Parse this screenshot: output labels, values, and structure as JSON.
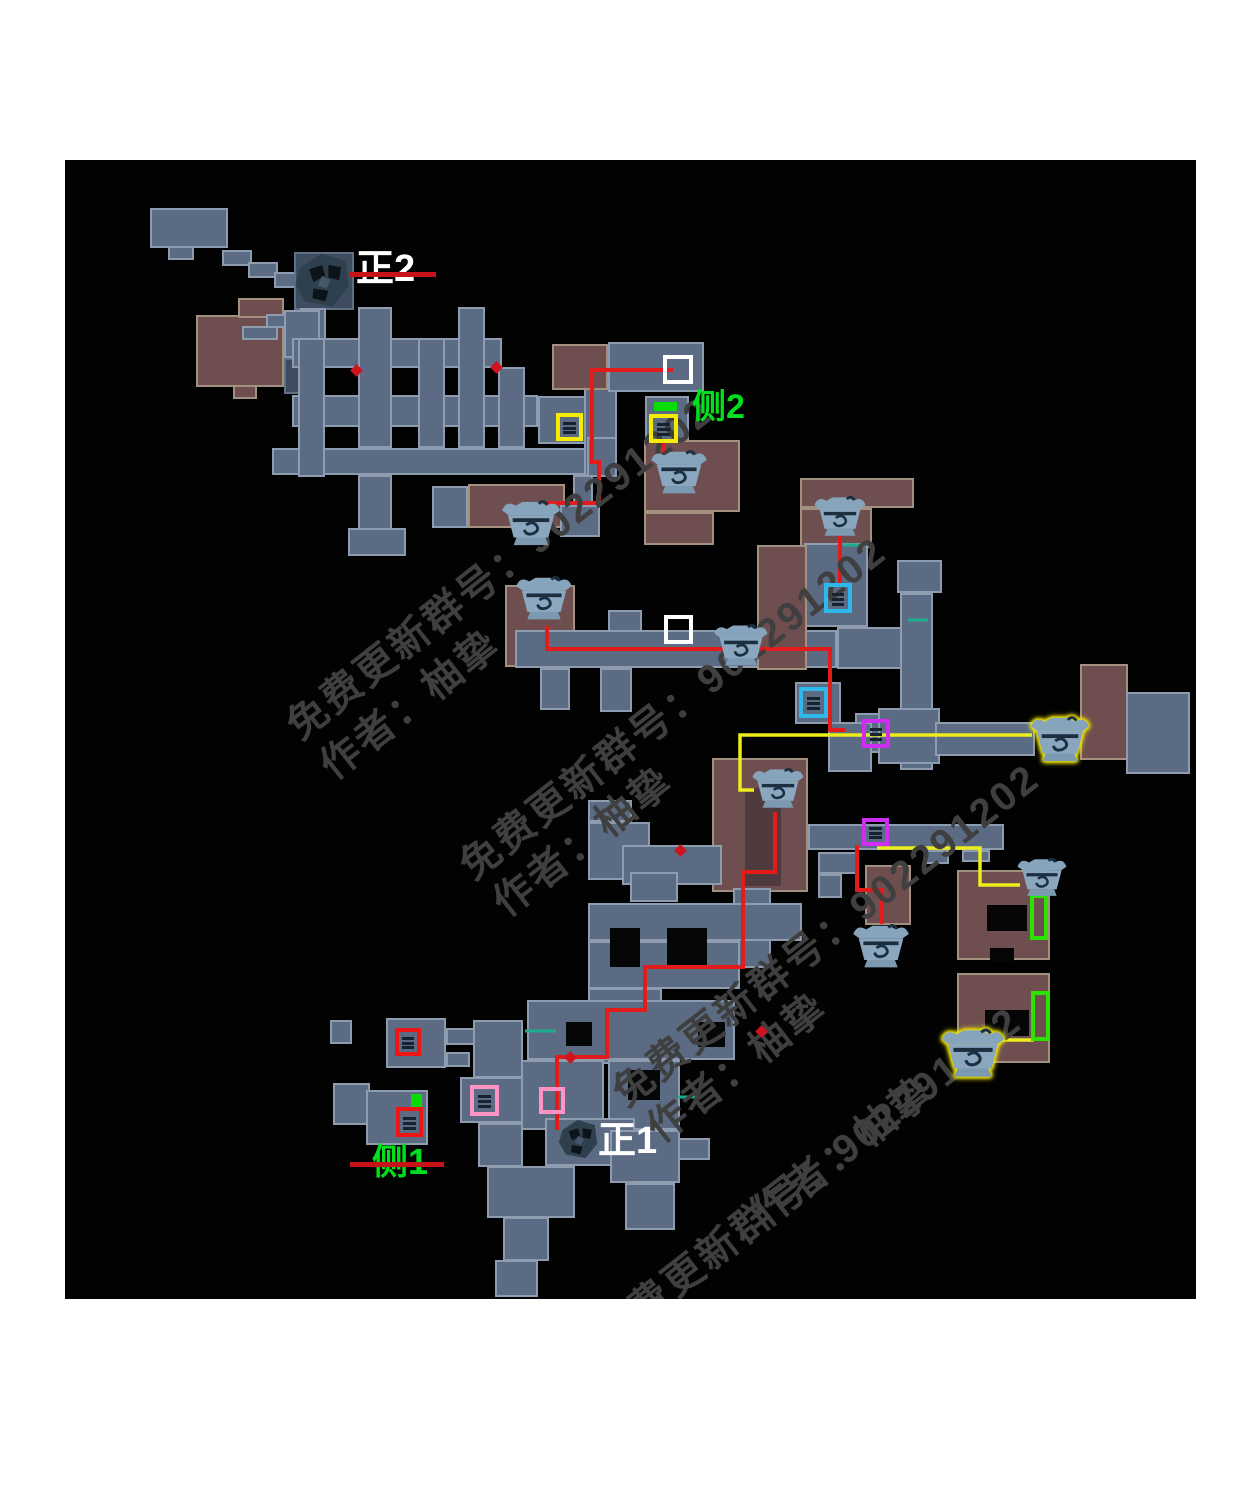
{
  "map": {
    "area": {
      "x": 65,
      "y": 160,
      "w": 1131,
      "h": 1139
    },
    "colors": {
      "background": "#020202",
      "page": "#ffffff",
      "room_gray": "#5b6b83",
      "room_maroon": "#6f4e50",
      "red_path": "#e31b1b",
      "yellow_path": "#eded1a",
      "teal_tick": "#1fae8d",
      "watermark": "#3f3f3f",
      "label_green": "#00e01e",
      "label_white": "#ffffff"
    },
    "rooms": [
      [
        196,
        315,
        88,
        72,
        "m"
      ],
      [
        238,
        298,
        46,
        20,
        "m"
      ],
      [
        233,
        385,
        24,
        14,
        "m"
      ],
      [
        150,
        208,
        78,
        40,
        "g"
      ],
      [
        168,
        246,
        26,
        14,
        "g"
      ],
      [
        222,
        250,
        30,
        16,
        "g"
      ],
      [
        248,
        262,
        30,
        16,
        "g"
      ],
      [
        274,
        272,
        30,
        16,
        "g"
      ],
      [
        294,
        252,
        60,
        58,
        "gd"
      ],
      [
        300,
        308,
        26,
        32,
        "g"
      ],
      [
        266,
        314,
        36,
        14,
        "g"
      ],
      [
        242,
        326,
        36,
        14,
        "g"
      ],
      [
        284,
        310,
        36,
        48,
        "g"
      ],
      [
        284,
        358,
        36,
        36,
        "gd"
      ],
      [
        292,
        338,
        210,
        30,
        "g"
      ],
      [
        292,
        395,
        246,
        32,
        "g"
      ],
      [
        538,
        396,
        54,
        48,
        "g"
      ],
      [
        272,
        448,
        320,
        27,
        "g"
      ],
      [
        298,
        338,
        27,
        139,
        "g"
      ],
      [
        358,
        307,
        34,
        141,
        "g"
      ],
      [
        358,
        475,
        34,
        55,
        "g"
      ],
      [
        348,
        528,
        58,
        28,
        "g"
      ],
      [
        418,
        338,
        27,
        110,
        "g"
      ],
      [
        458,
        307,
        27,
        141,
        "g"
      ],
      [
        498,
        367,
        27,
        81,
        "g"
      ],
      [
        584,
        362,
        33,
        114,
        "g"
      ],
      [
        587,
        437,
        30,
        40,
        "g"
      ],
      [
        573,
        475,
        20,
        30,
        "g"
      ],
      [
        432,
        486,
        36,
        42,
        "g"
      ],
      [
        468,
        484,
        97,
        44,
        "m"
      ],
      [
        560,
        505,
        40,
        32,
        "g"
      ],
      [
        552,
        344,
        56,
        46,
        "m"
      ],
      [
        608,
        342,
        96,
        50,
        "g"
      ],
      [
        645,
        396,
        44,
        50,
        "g"
      ],
      [
        644,
        440,
        96,
        72,
        "m"
      ],
      [
        644,
        512,
        70,
        33,
        "m"
      ],
      [
        800,
        478,
        114,
        30,
        "m"
      ],
      [
        800,
        508,
        72,
        40,
        "m"
      ],
      [
        804,
        543,
        64,
        84,
        "g"
      ],
      [
        505,
        585,
        70,
        82,
        "m"
      ],
      [
        515,
        630,
        322,
        38,
        "g"
      ],
      [
        540,
        668,
        30,
        42,
        "g"
      ],
      [
        600,
        668,
        32,
        44,
        "g"
      ],
      [
        608,
        610,
        34,
        22,
        "g"
      ],
      [
        757,
        545,
        50,
        125,
        "m"
      ],
      [
        837,
        627,
        68,
        42,
        "g"
      ],
      [
        897,
        560,
        45,
        33,
        "g"
      ],
      [
        900,
        593,
        33,
        177,
        "g"
      ],
      [
        795,
        682,
        46,
        42,
        "g"
      ],
      [
        855,
        713,
        46,
        40,
        "g"
      ],
      [
        828,
        722,
        44,
        50,
        "g"
      ],
      [
        878,
        708,
        62,
        56,
        "g"
      ],
      [
        935,
        722,
        100,
        34,
        "g"
      ],
      [
        1080,
        664,
        48,
        96,
        "m"
      ],
      [
        1126,
        692,
        64,
        82,
        "g"
      ],
      [
        808,
        824,
        196,
        26,
        "g"
      ],
      [
        925,
        850,
        24,
        14,
        "g"
      ],
      [
        962,
        850,
        28,
        12,
        "g"
      ],
      [
        818,
        852,
        40,
        22,
        "g"
      ],
      [
        818,
        874,
        24,
        24,
        "g"
      ],
      [
        865,
        865,
        46,
        60,
        "m"
      ],
      [
        957,
        870,
        93,
        90,
        "m"
      ],
      [
        957,
        973,
        93,
        90,
        "m"
      ],
      [
        712,
        758,
        96,
        134,
        "m"
      ],
      [
        745,
        788,
        36,
        98,
        "md"
      ],
      [
        588,
        800,
        44,
        22,
        "g"
      ],
      [
        588,
        822,
        62,
        58,
        "g"
      ],
      [
        622,
        845,
        100,
        40,
        "g"
      ],
      [
        630,
        872,
        48,
        30,
        "g"
      ],
      [
        733,
        888,
        38,
        80,
        "g"
      ],
      [
        588,
        903,
        214,
        38,
        "g"
      ],
      [
        588,
        941,
        152,
        48,
        "g"
      ],
      [
        588,
        988,
        74,
        28,
        "g"
      ],
      [
        600,
        1014,
        62,
        50,
        "g"
      ],
      [
        527,
        1000,
        208,
        60,
        "g"
      ],
      [
        520,
        1060,
        84,
        70,
        "g"
      ],
      [
        608,
        1060,
        72,
        70,
        "g"
      ],
      [
        545,
        1118,
        90,
        48,
        "g"
      ],
      [
        487,
        1166,
        88,
        52,
        "g"
      ],
      [
        503,
        1217,
        46,
        44,
        "g"
      ],
      [
        495,
        1260,
        43,
        37,
        "g"
      ],
      [
        610,
        1130,
        70,
        53,
        "g"
      ],
      [
        625,
        1183,
        50,
        47,
        "g"
      ],
      [
        678,
        1138,
        32,
        22,
        "g"
      ],
      [
        386,
        1018,
        60,
        50,
        "g"
      ],
      [
        446,
        1028,
        32,
        17,
        "g"
      ],
      [
        446,
        1052,
        24,
        15,
        "g"
      ],
      [
        330,
        1020,
        22,
        24,
        "g"
      ],
      [
        333,
        1083,
        37,
        42,
        "g"
      ],
      [
        366,
        1090,
        62,
        55,
        "g"
      ],
      [
        473,
        1020,
        50,
        58,
        "g"
      ],
      [
        460,
        1077,
        63,
        46,
        "g"
      ],
      [
        478,
        1123,
        45,
        44,
        "g"
      ]
    ],
    "holes": [
      [
        566,
        1022,
        26,
        24
      ],
      [
        698,
        1022,
        27,
        25
      ],
      [
        628,
        1070,
        32,
        30
      ],
      [
        610,
        928,
        30,
        39
      ],
      [
        667,
        928,
        40,
        39
      ],
      [
        987,
        905,
        40,
        26
      ],
      [
        990,
        948,
        24,
        14
      ],
      [
        985,
        1010,
        44,
        26
      ]
    ],
    "paths": [
      {
        "c": "red",
        "pts": [
          [
            673,
            370
          ],
          [
            592,
            370
          ],
          [
            592,
            462
          ],
          [
            599,
            462
          ],
          [
            599,
            503
          ],
          [
            548,
            503
          ],
          [
            548,
            512
          ]
        ]
      },
      {
        "c": "red",
        "pts": [
          [
            664,
            441
          ],
          [
            664,
            458
          ]
        ]
      },
      {
        "c": "red",
        "pts": [
          [
            840,
            535
          ],
          [
            840,
            586
          ]
        ]
      },
      {
        "c": "red",
        "pts": [
          [
            547,
            626
          ],
          [
            547,
            649
          ],
          [
            830,
            649
          ],
          [
            830,
            730
          ],
          [
            845,
            730
          ]
        ]
      },
      {
        "c": "red",
        "pts": [
          [
            857,
            845
          ],
          [
            857,
            890
          ],
          [
            882,
            890
          ],
          [
            882,
            924
          ]
        ]
      },
      {
        "c": "red",
        "pts": [
          [
            775,
            812
          ],
          [
            775,
            872
          ],
          [
            743,
            872
          ],
          [
            743,
            967
          ],
          [
            645,
            967
          ],
          [
            645,
            1010
          ],
          [
            607,
            1010
          ],
          [
            607,
            1057
          ],
          [
            557,
            1057
          ],
          [
            557,
            1130
          ]
        ]
      },
      {
        "c": "yellow",
        "pts": [
          [
            754,
            790
          ],
          [
            740,
            790
          ],
          [
            740,
            735
          ],
          [
            1032,
            735
          ]
        ]
      },
      {
        "c": "yellow",
        "pts": [
          [
            877,
            848
          ],
          [
            980,
            848
          ],
          [
            980,
            885
          ],
          [
            1020,
            885
          ]
        ]
      },
      {
        "c": "yellow",
        "pts": [
          [
            1002,
            1040
          ],
          [
            1034,
            1040
          ]
        ]
      }
    ],
    "markers": [
      [
        663,
        355,
        30,
        29,
        "#ffffff",
        false
      ],
      [
        664,
        615,
        29,
        29,
        "#ffffff",
        false
      ],
      [
        556,
        413,
        27,
        28,
        "#f6ec00",
        true
      ],
      [
        649,
        414,
        29,
        29,
        "#f6ec00",
        true
      ],
      [
        824,
        583,
        28,
        30,
        "#2fb9ea",
        true
      ],
      [
        799,
        687,
        29,
        31,
        "#2fb9ea",
        true
      ],
      [
        862,
        719,
        28,
        29,
        "#cf2df2",
        true
      ],
      [
        862,
        818,
        27,
        28,
        "#cf2df2",
        true
      ],
      [
        470,
        1085,
        29,
        31,
        "#ff93c4",
        true
      ],
      [
        539,
        1087,
        26,
        27,
        "#ff93c4",
        false
      ],
      [
        395,
        1028,
        26,
        28,
        "#ee1515",
        true
      ],
      [
        396,
        1107,
        27,
        30,
        "#ee1515",
        true
      ],
      [
        1030,
        894,
        18,
        46,
        "#2ce300",
        false
      ],
      [
        1031,
        991,
        19,
        50,
        "#2ce300",
        false
      ]
    ],
    "platforms": [
      [
        654,
        402,
        23,
        9
      ],
      [
        411,
        1094,
        11,
        17
      ]
    ],
    "chests": [
      [
        500,
        498,
        62,
        52,
        false
      ],
      [
        648,
        448,
        62,
        50,
        false
      ],
      [
        810,
        494,
        60,
        46,
        false
      ],
      [
        512,
        574,
        64,
        50,
        false
      ],
      [
        712,
        622,
        58,
        48,
        false
      ],
      [
        1028,
        714,
        64,
        52,
        true
      ],
      [
        748,
        766,
        60,
        46,
        false
      ],
      [
        850,
        922,
        62,
        50,
        false
      ],
      [
        1014,
        856,
        56,
        44,
        false
      ],
      [
        940,
        1026,
        66,
        56,
        true
      ]
    ],
    "bosses": [
      [
        290,
        248,
        64,
        64
      ],
      [
        554,
        1116,
        48,
        46
      ]
    ],
    "dots": [
      [
        352,
        366
      ],
      [
        492,
        363
      ],
      [
        676,
        846
      ],
      [
        566,
        1053
      ],
      [
        757,
        1027
      ]
    ],
    "ticks": [
      [
        843,
        545,
        862,
        545
      ],
      [
        908,
        620,
        928,
        620
      ],
      [
        525,
        1031,
        556,
        1031
      ],
      [
        678,
        1097,
        702,
        1097
      ]
    ],
    "labels": [
      {
        "n": "label-main-boss-2",
        "t": "正2",
        "x": 356,
        "y": 250,
        "s": 38,
        "c": "#ffffff"
      },
      {
        "n": "label-side-boss-2",
        "t": "侧2",
        "x": 692,
        "y": 390,
        "s": 34,
        "c": "#00e01e"
      },
      {
        "n": "label-main-boss-1",
        "t": "正1",
        "x": 598,
        "y": 1122,
        "s": 38,
        "c": "#ffffff"
      },
      {
        "n": "label-side-boss-1",
        "t": "侧1",
        "x": 372,
        "y": 1144,
        "s": 36,
        "c": "#00e01e"
      }
    ],
    "strikes": [
      [
        350,
        272,
        86
      ],
      [
        350,
        1162,
        94
      ]
    ],
    "watermarks": [
      {
        "t": "免费更新群号：902291202",
        "x": 272,
        "y": 705
      },
      {
        "t": "作者：柚挚",
        "x": 305,
        "y": 745
      },
      {
        "t": "免费更新群号：902291202",
        "x": 445,
        "y": 845
      },
      {
        "t": "作者：柚挚",
        "x": 478,
        "y": 882
      },
      {
        "t": "免费更新群号：902291202",
        "x": 598,
        "y": 1072
      },
      {
        "t": "作者：柚挚",
        "x": 632,
        "y": 1108
      },
      {
        "t": "免费更新群号：902291202",
        "x": 580,
        "y": 1315
      },
      {
        "t": "作者：柚挚",
        "x": 738,
        "y": 1192
      }
    ]
  }
}
